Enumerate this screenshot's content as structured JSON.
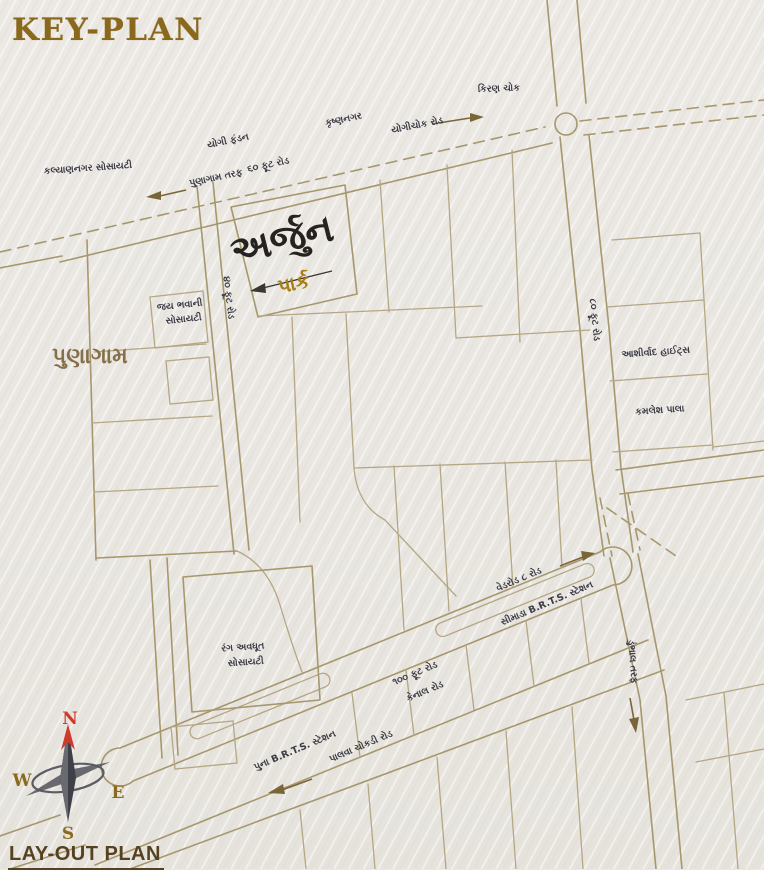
{
  "page": {
    "title": "KEY-PLAN",
    "footer": "LAY-OUT PLAN"
  },
  "colors": {
    "background": "#e9e7e2",
    "road_line": "#a6976d",
    "title_brown": "#8a681c",
    "footer_brown": "#564120",
    "label_dark": "#3b3b45",
    "region_brown": "#85704a",
    "park_gold": "#a87d12",
    "compass_red": "#cf3b2a"
  },
  "map": {
    "region_label": "પુણાગામ",
    "project_title": "અર્જુન",
    "project_subtitle": "પાર્ક",
    "labels": {
      "kiran_chowk": "કિરણ ચોક",
      "yogi_fundan": "યોગી ફંડન",
      "krushnanagar": "કૃષ્ણનગર",
      "yogichowk_road": "યોગીચોક રોડ",
      "punagam_taraf": "પુણાગામ તરફ",
      "sixty_ft_road": "૬૦ ફૂટ રોડ",
      "kalyannagar_society": "કલ્યાણનગર સોસાયટી",
      "jay_bhavani_line1": "જય ભવાની",
      "jay_bhavani_line2": "સોસાયટી",
      "forty_ft_road": "૪૦ ફૂટ રોડ",
      "eighty_ft_road": "૮૦ ફૂટ રોડ",
      "ashirwad_heights": "આશીર્વાદ હાઈટ્સ",
      "kamlesh_pala": "કમલેશ પાલા",
      "vedroad_8_road": "વેડરોડ ૮ રોડ",
      "simada_brts_station": "સીમાડા B.R.T.S. સ્ટેશન",
      "hundred_ft_road": "૧૦૦ ફૂટ રોડ",
      "canal_road": "કેનાલ રોડ",
      "puna_brts_station": "પુના B.R.T.S. સ્ટેશન",
      "palwa_chokdi_road": "પાલવા ચોકડી રોડ",
      "rang_avdhut_line1": "રંગ અવધૂત",
      "rang_avdhut_line2": "સોસાયટી",
      "dumbhal_taraf": "ડુંભાલ તરફ"
    }
  },
  "compass": {
    "north": "N",
    "south": "S",
    "east": "E",
    "west": "W"
  }
}
